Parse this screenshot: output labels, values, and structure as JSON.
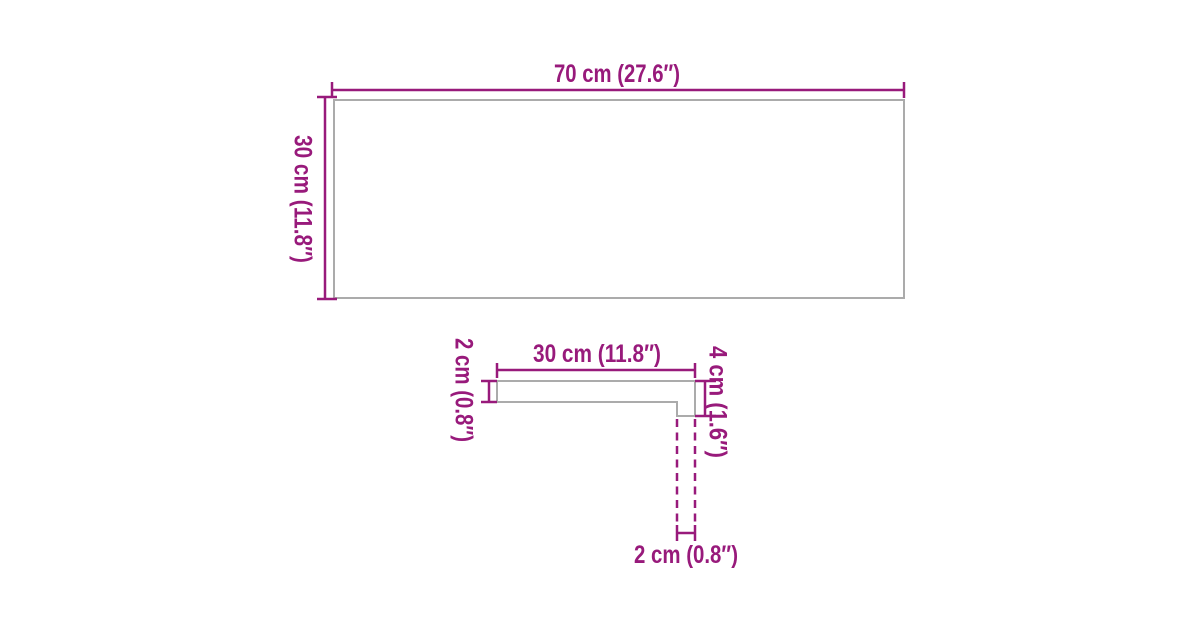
{
  "colors": {
    "accent": "#981a7b",
    "outline": "#ababab",
    "background": "#ffffff"
  },
  "front_view": {
    "width_label": "70 cm (27.6″)",
    "height_label": "30 cm (11.8″)"
  },
  "profile_view": {
    "width_label": "30 cm (11.8″)",
    "thickness_label": "2 cm (0.8″)",
    "edge_height_label": "4 cm (1.6″)",
    "edge_depth_label": "2 cm (0.8″)"
  }
}
